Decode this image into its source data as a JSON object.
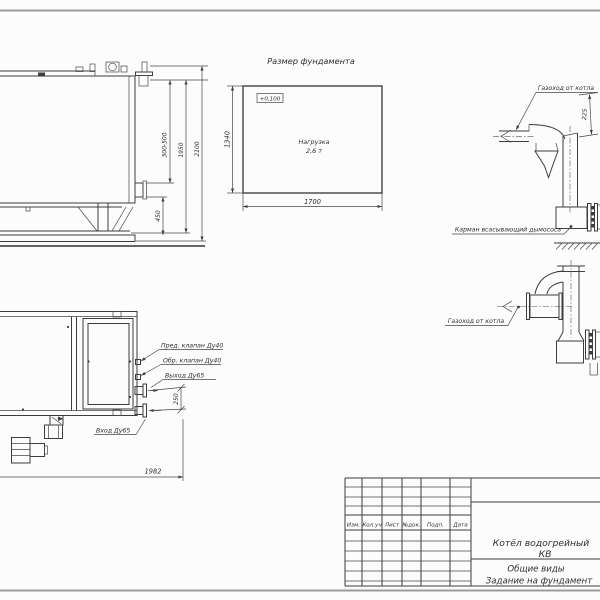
{
  "side_view": {
    "dim_nozzle_range": "300-500",
    "dim_height": "1950",
    "dim_total_height": "2100",
    "dim_base": "450"
  },
  "foundation_plan": {
    "title": "Размер фундамента",
    "elevation_mark": "+0,100",
    "load_line1": "Нагрузка",
    "load_line2": "2,6 т",
    "dim_length": "1700",
    "dim_width": "1340"
  },
  "flue_view_top": {
    "flue_label": "Газоход от котла",
    "dim_offset": "225",
    "pocket_label": "Карман всасывающий дымососа"
  },
  "flue_view_side": {
    "flue_label": "Газоход от котла"
  },
  "plan_view": {
    "safety_valve_label": "Пред. клапан Ду40",
    "check_valve_label": "Обр. клапан Ду40",
    "outlet_label": "Выход Ду65",
    "inlet_label": "Вход Ду65",
    "dim_ports": "250",
    "dim_length": "1982"
  },
  "title_block": {
    "columns": [
      "Изм.",
      "Кол.уч",
      "Лист",
      "№док.",
      "Подп.",
      "Дата"
    ],
    "product_title_line1": "Котёл водогрейный",
    "product_title_line2": "КВ",
    "sheet_title_line1": "Общие виды",
    "sheet_title_line2": "Задание на фундамент"
  }
}
